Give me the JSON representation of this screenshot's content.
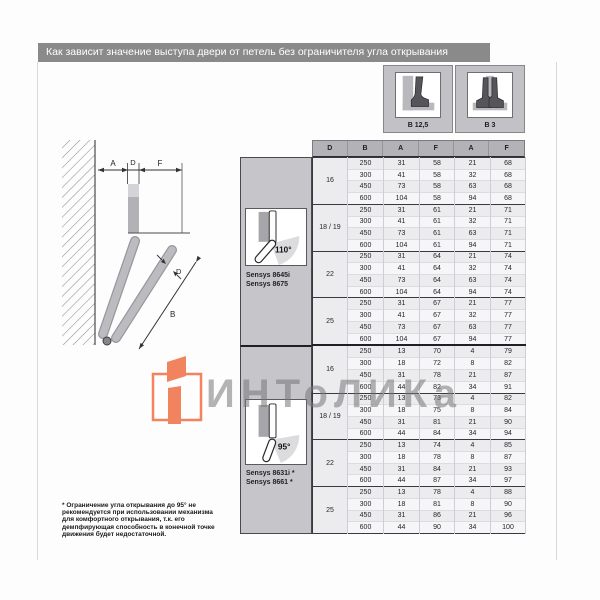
{
  "page": {
    "title": "Как зависит значение выступа двери от петель без ограничителя угла открывания"
  },
  "hinge_variants": [
    {
      "label": "B 12,5",
      "icon": "overlay-hinge-icon"
    },
    {
      "label": "B 3",
      "icon": "twin-hinge-icon"
    }
  ],
  "diagram": {
    "labels": {
      "a": "A",
      "d_top": "D",
      "f": "F",
      "d_door": "D",
      "b": "B"
    }
  },
  "table": {
    "header": [
      "D",
      "B",
      "A",
      "F",
      "A",
      "F"
    ],
    "sections": [
      {
        "angle_label": "110°",
        "models": [
          "Sensys 8645i",
          "Sensys 8675"
        ],
        "groups": [
          {
            "d": "16",
            "rows": [
              [
                250,
                31,
                58,
                21,
                68
              ],
              [
                300,
                41,
                58,
                32,
                68
              ],
              [
                450,
                73,
                58,
                63,
                68
              ],
              [
                600,
                104,
                58,
                94,
                68
              ]
            ]
          },
          {
            "d": "18 / 19",
            "rows": [
              [
                250,
                31,
                61,
                21,
                71
              ],
              [
                300,
                41,
                61,
                32,
                71
              ],
              [
                450,
                73,
                61,
                63,
                71
              ],
              [
                600,
                104,
                61,
                94,
                71
              ]
            ]
          },
          {
            "d": "22",
            "rows": [
              [
                250,
                31,
                64,
                21,
                74
              ],
              [
                300,
                41,
                64,
                32,
                74
              ],
              [
                450,
                73,
                64,
                63,
                74
              ],
              [
                600,
                104,
                64,
                94,
                74
              ]
            ]
          },
          {
            "d": "25",
            "rows": [
              [
                250,
                31,
                67,
                21,
                77
              ],
              [
                300,
                41,
                67,
                32,
                77
              ],
              [
                450,
                73,
                67,
                63,
                77
              ],
              [
                600,
                104,
                67,
                94,
                77
              ]
            ]
          }
        ]
      },
      {
        "angle_label": "95°",
        "models": [
          "Sensys 8631i *",
          "Sensys 8661 *"
        ],
        "groups": [
          {
            "d": "16",
            "rows": [
              [
                250,
                13,
                70,
                4,
                79
              ],
              [
                300,
                18,
                72,
                8,
                82
              ],
              [
                450,
                31,
                78,
                21,
                87
              ],
              [
                600,
                44,
                82,
                34,
                91
              ]
            ]
          },
          {
            "d": "18 / 19",
            "rows": [
              [
                250,
                13,
                73,
                4,
                82
              ],
              [
                300,
                18,
                75,
                8,
                84
              ],
              [
                450,
                31,
                81,
                21,
                90
              ],
              [
                600,
                44,
                84,
                34,
                94
              ]
            ]
          },
          {
            "d": "22",
            "rows": [
              [
                250,
                13,
                74,
                4,
                85
              ],
              [
                300,
                18,
                78,
                8,
                87
              ],
              [
                450,
                31,
                84,
                21,
                93
              ],
              [
                600,
                44,
                87,
                34,
                97
              ]
            ]
          },
          {
            "d": "25",
            "rows": [
              [
                250,
                13,
                78,
                4,
                88
              ],
              [
                300,
                18,
                81,
                8,
                90
              ],
              [
                450,
                31,
                86,
                21,
                96
              ],
              [
                600,
                44,
                90,
                34,
                100
              ]
            ]
          }
        ]
      }
    ]
  },
  "watermark": {
    "text": "ИНТоЛИКа",
    "logo_color": "#f2835f",
    "text_color": "#767676"
  },
  "footnote": "* Ограничение угла открывания до 95° не\nрекомендуется при использовании механизма\nдля комфортного открывания, т.к. его\nдемпфирующая способность в конечной точке\nдвижения будет недостаточной.",
  "colors": {
    "title_bar": "#8a8a8a",
    "header_gray": "#b3b3b7",
    "panel_gray": "#c6c6ca",
    "row_stripe": "#ececef",
    "accent_orange": "#f2835f"
  }
}
